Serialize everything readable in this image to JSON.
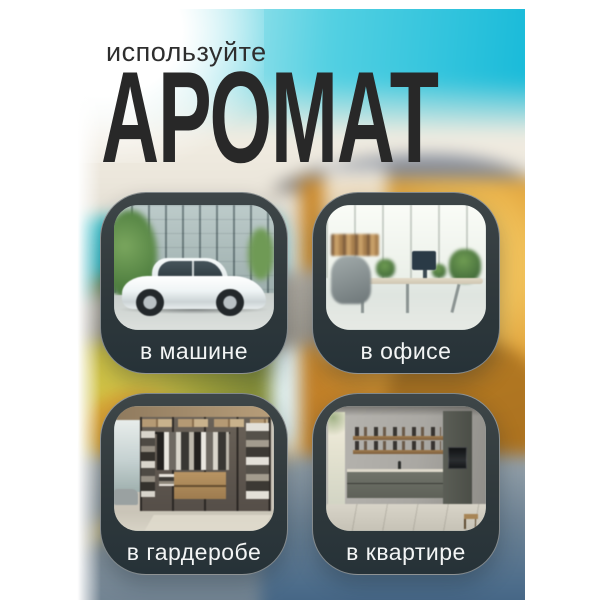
{
  "header": {
    "kicker": "используйте",
    "title": "АРОМАТ"
  },
  "cards": [
    {
      "id": "car",
      "label": "в машине",
      "photo_alt": "белый седан у стеклянного здания"
    },
    {
      "id": "office",
      "label": "в офисе",
      "photo_alt": "светлый современный офис со столами и растениями"
    },
    {
      "id": "wardrobe",
      "label": "в гардеробе",
      "photo_alt": "открытая гардеробная с одеждой и полками"
    },
    {
      "id": "apartment",
      "label": "в квартире",
      "photo_alt": "современная кухня в квартире"
    }
  ],
  "colors": {
    "canvas": "#ffffff",
    "title_text": "#282828",
    "card_background": "#30393c",
    "card_border": "rgba(255,255,255,0.42)",
    "label_text": "#f3f5f5",
    "sky_cyan": "#12b8d8",
    "foliage_orange": "#dd9c34",
    "flowers_yellow": "#cfc246",
    "water_blue": "#4a6b8a",
    "light_streak": "#ffd865"
  }
}
